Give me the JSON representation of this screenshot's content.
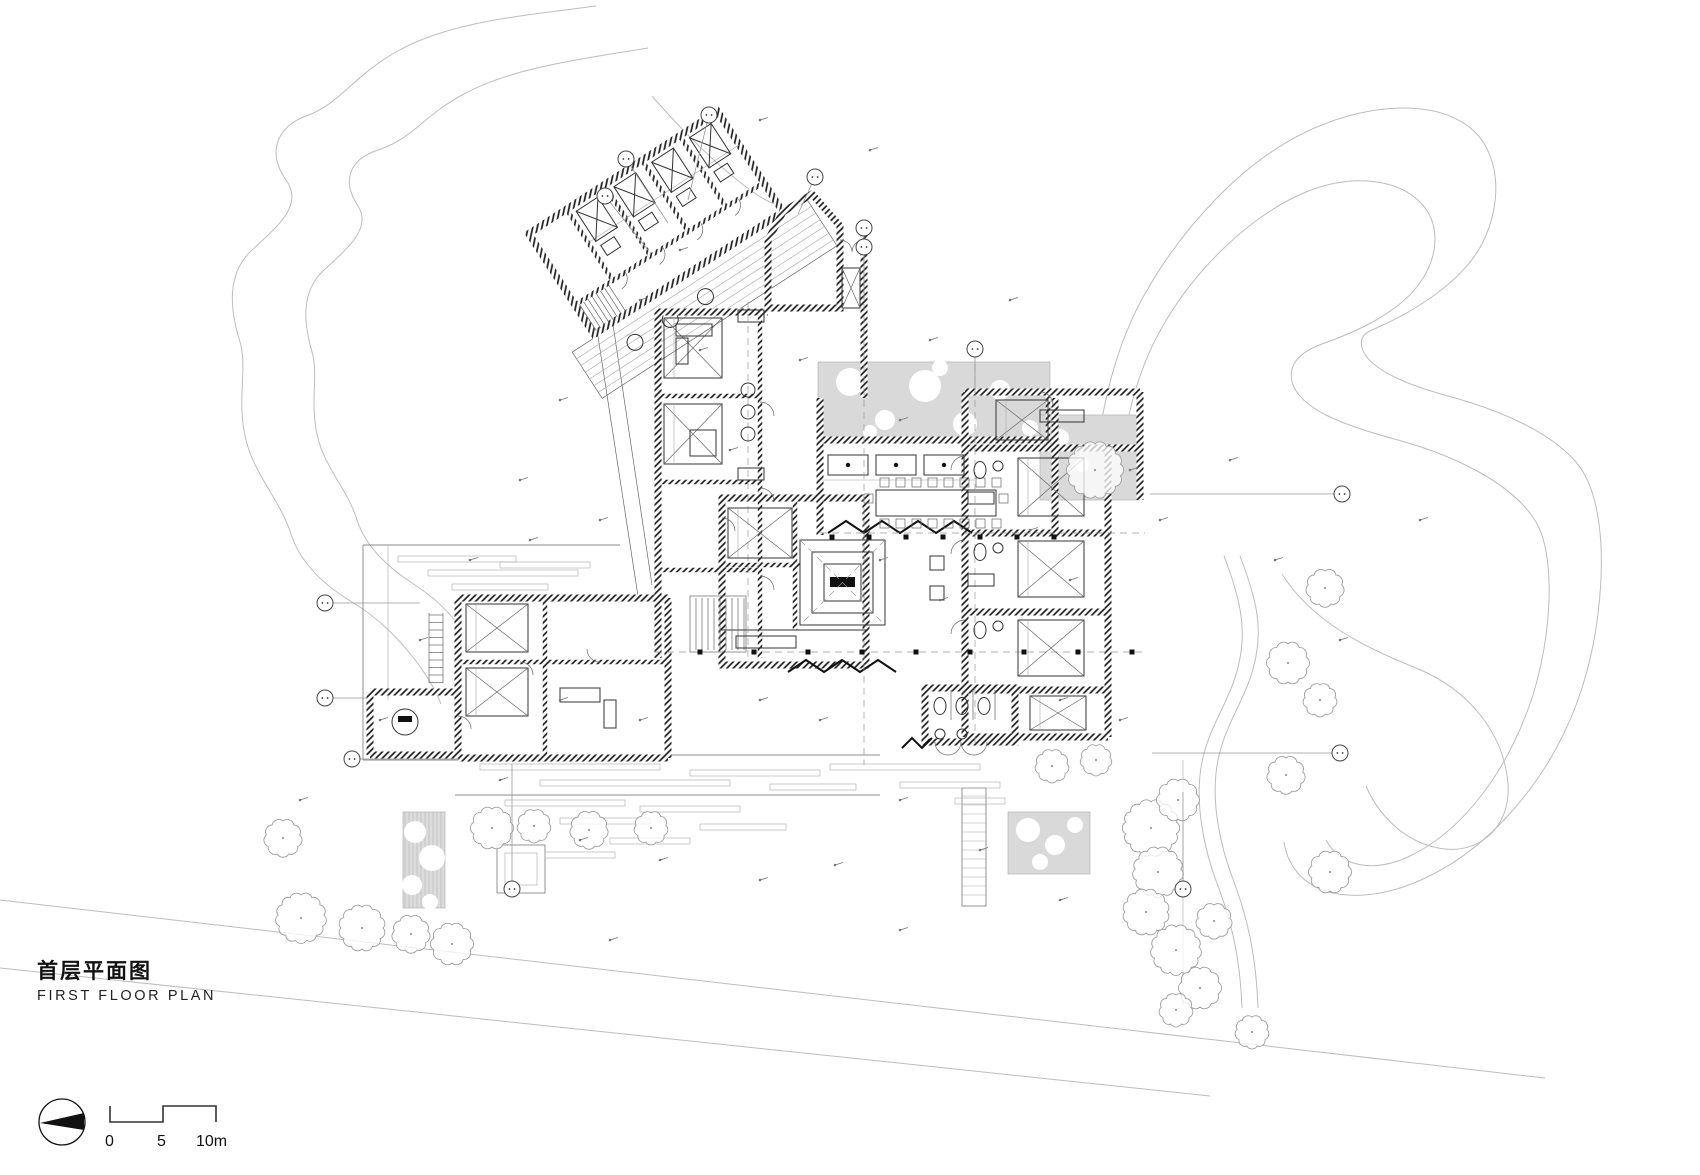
{
  "title_block": {
    "title_cn": "首层平面图",
    "title_en": "FIRST FLOOR PLAN"
  },
  "scale_bar": {
    "zero": "0",
    "five": "5",
    "ten": "10m"
  },
  "icons": {
    "north_arrow": "north-arrow",
    "grid_bubble": "grid-bubble",
    "tree": "tree-symbol"
  },
  "colors": {
    "paper": "#ffffff",
    "ink": "#1a1a1a",
    "wall_hatch": "#1c1c1c",
    "site_line": "#bdbdbd",
    "planting_fill": "#d9d9d9"
  }
}
